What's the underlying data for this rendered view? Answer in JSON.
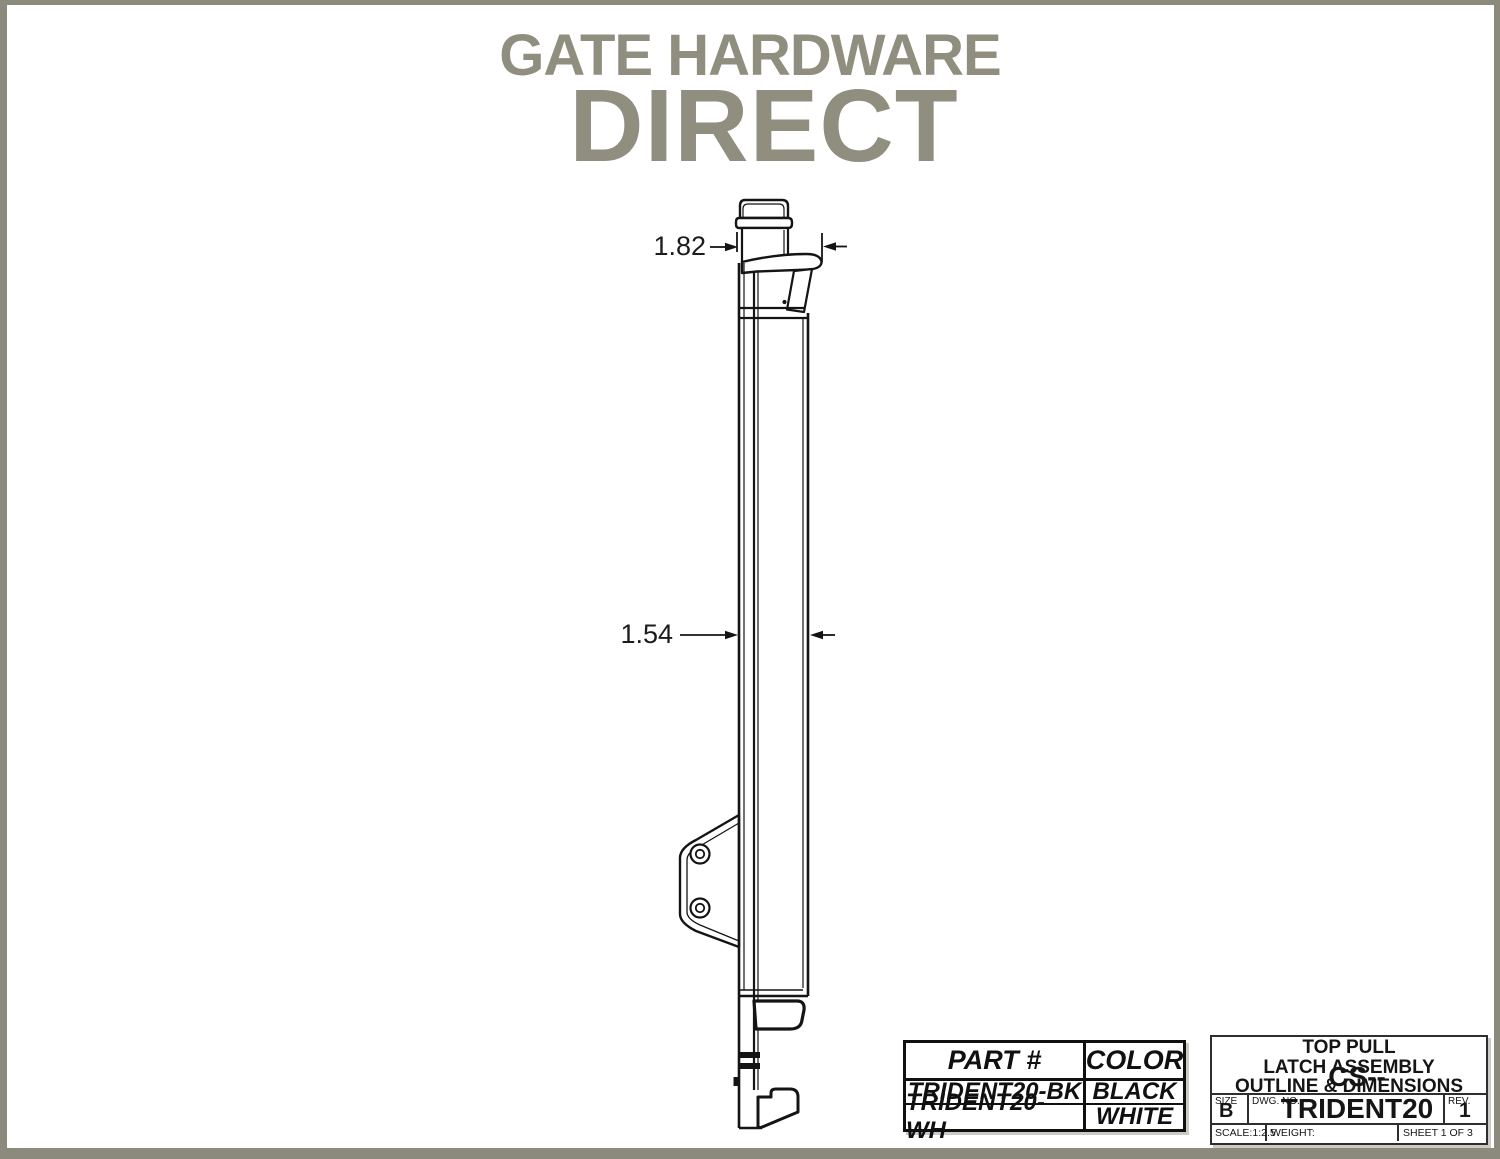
{
  "page": {
    "frame_color": "#8b8a7c",
    "background": "#ffffff",
    "line_color": "#141414"
  },
  "logo": {
    "line1": "GATE HARDWARE",
    "line2": "DIRECT",
    "color": "#8f8e7f"
  },
  "drawing": {
    "description": "side-view outline drawing of top pull gate latch assembly",
    "dim_top": {
      "label": "1.82"
    },
    "dim_body": {
      "label": "1.54"
    }
  },
  "parts_table": {
    "headers": {
      "part": "PART #",
      "color": "COLOR"
    },
    "rows": [
      {
        "part": "TRIDENT20-BK",
        "color": "BLACK"
      },
      {
        "part": "TRIDENT20-WH",
        "color": "WHITE"
      }
    ]
  },
  "title_block": {
    "title_line1": "TOP PULL",
    "title_line2": "LATCH ASSEMBLY",
    "title_line3": "OUTLINE & DIMENSIONS",
    "size_label": "SIZE",
    "size_value": "B",
    "dwg_label": "DWG.  NO.",
    "dwg_value": "CS--TRIDENT20",
    "rev_label": "REV.",
    "rev_value": "1",
    "scale": "SCALE:1:2.5",
    "weight_label": "WEIGHT:",
    "sheet": "SHEET 1 OF 3"
  }
}
